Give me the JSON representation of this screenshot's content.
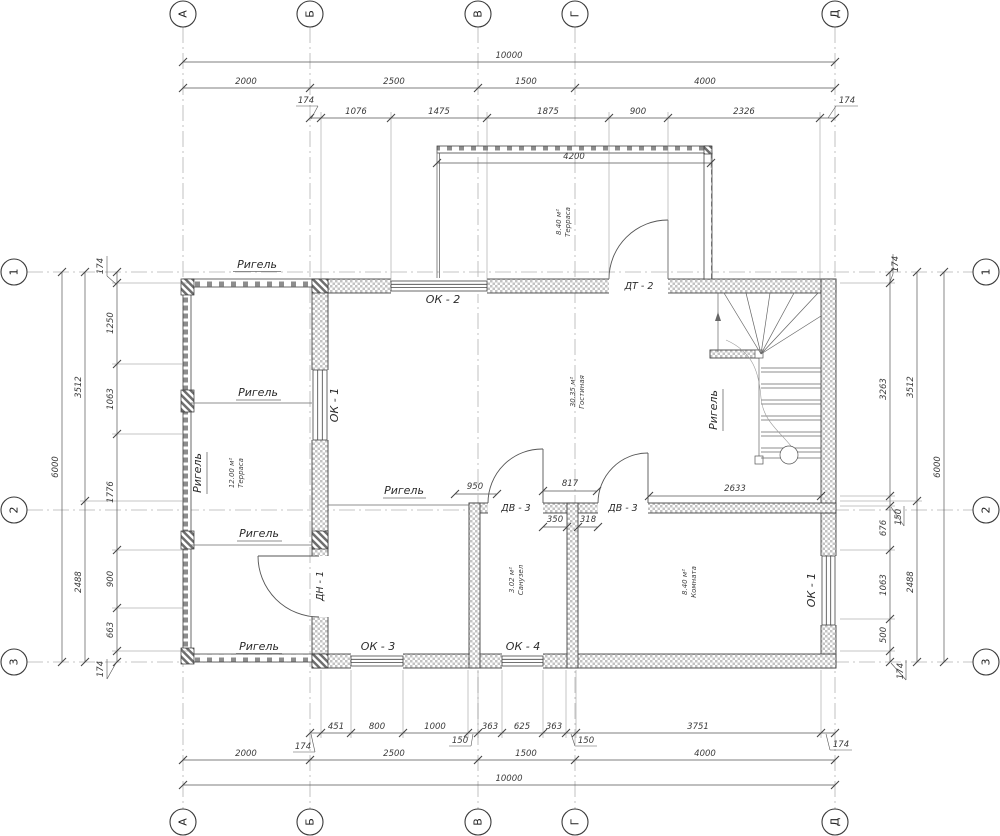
{
  "axes": {
    "columns": [
      "А",
      "Б",
      "В",
      "Г",
      "Д"
    ],
    "rows": [
      "1",
      "2",
      "3"
    ]
  },
  "dims": {
    "top_total": "10000",
    "top_spans": [
      "2000",
      "2500",
      "1500",
      "4000"
    ],
    "top_detail": [
      "1076",
      "1475",
      "1875",
      "900",
      "2326"
    ],
    "top_off_left": "174",
    "top_off_right": "174",
    "terrace_width": "4200",
    "bottom_detail": [
      "451",
      "800",
      "1000",
      "363",
      "625",
      "363",
      "3751"
    ],
    "bottom_off": [
      "174",
      "150",
      "150",
      "174"
    ],
    "bottom_spans": [
      "2000",
      "2500",
      "1500",
      "4000"
    ],
    "bottom_total": "10000",
    "left_detail": [
      "1250",
      "1063",
      "1776",
      "900",
      "663"
    ],
    "left_off": [
      "174",
      "174"
    ],
    "left_spans": [
      "3512",
      "2488"
    ],
    "left_total": "6000",
    "right_detail": [
      "3263",
      "676",
      "1063",
      "500"
    ],
    "right_off": [
      "174",
      "150",
      "174"
    ],
    "right_spans": [
      "3512",
      "2488"
    ],
    "right_total": "6000",
    "int_950": "950",
    "int_817": "817",
    "int_350": "350",
    "int_318": "318",
    "int_2633": "2633"
  },
  "rooms": {
    "terrace_top": {
      "name": "Терраса",
      "area": "8.40 м²"
    },
    "terrace_left": {
      "name": "Терраса",
      "area": "12.00 м²"
    },
    "living": {
      "name": "Гостиная",
      "area": "30.35 м²"
    },
    "wc": {
      "name": "Санузел",
      "area": "3.02 м²"
    },
    "room": {
      "name": "Комната",
      "area": "8.40 м²"
    }
  },
  "openings": {
    "ok1": "ОК - 1",
    "ok2": "ОК - 2",
    "ok3": "ОК - 3",
    "ok4": "ОК - 4",
    "dt2": "ДТ - 2",
    "dv3": "ДВ - 3",
    "dn1": "ДН - 1"
  },
  "beam": "Ригель"
}
